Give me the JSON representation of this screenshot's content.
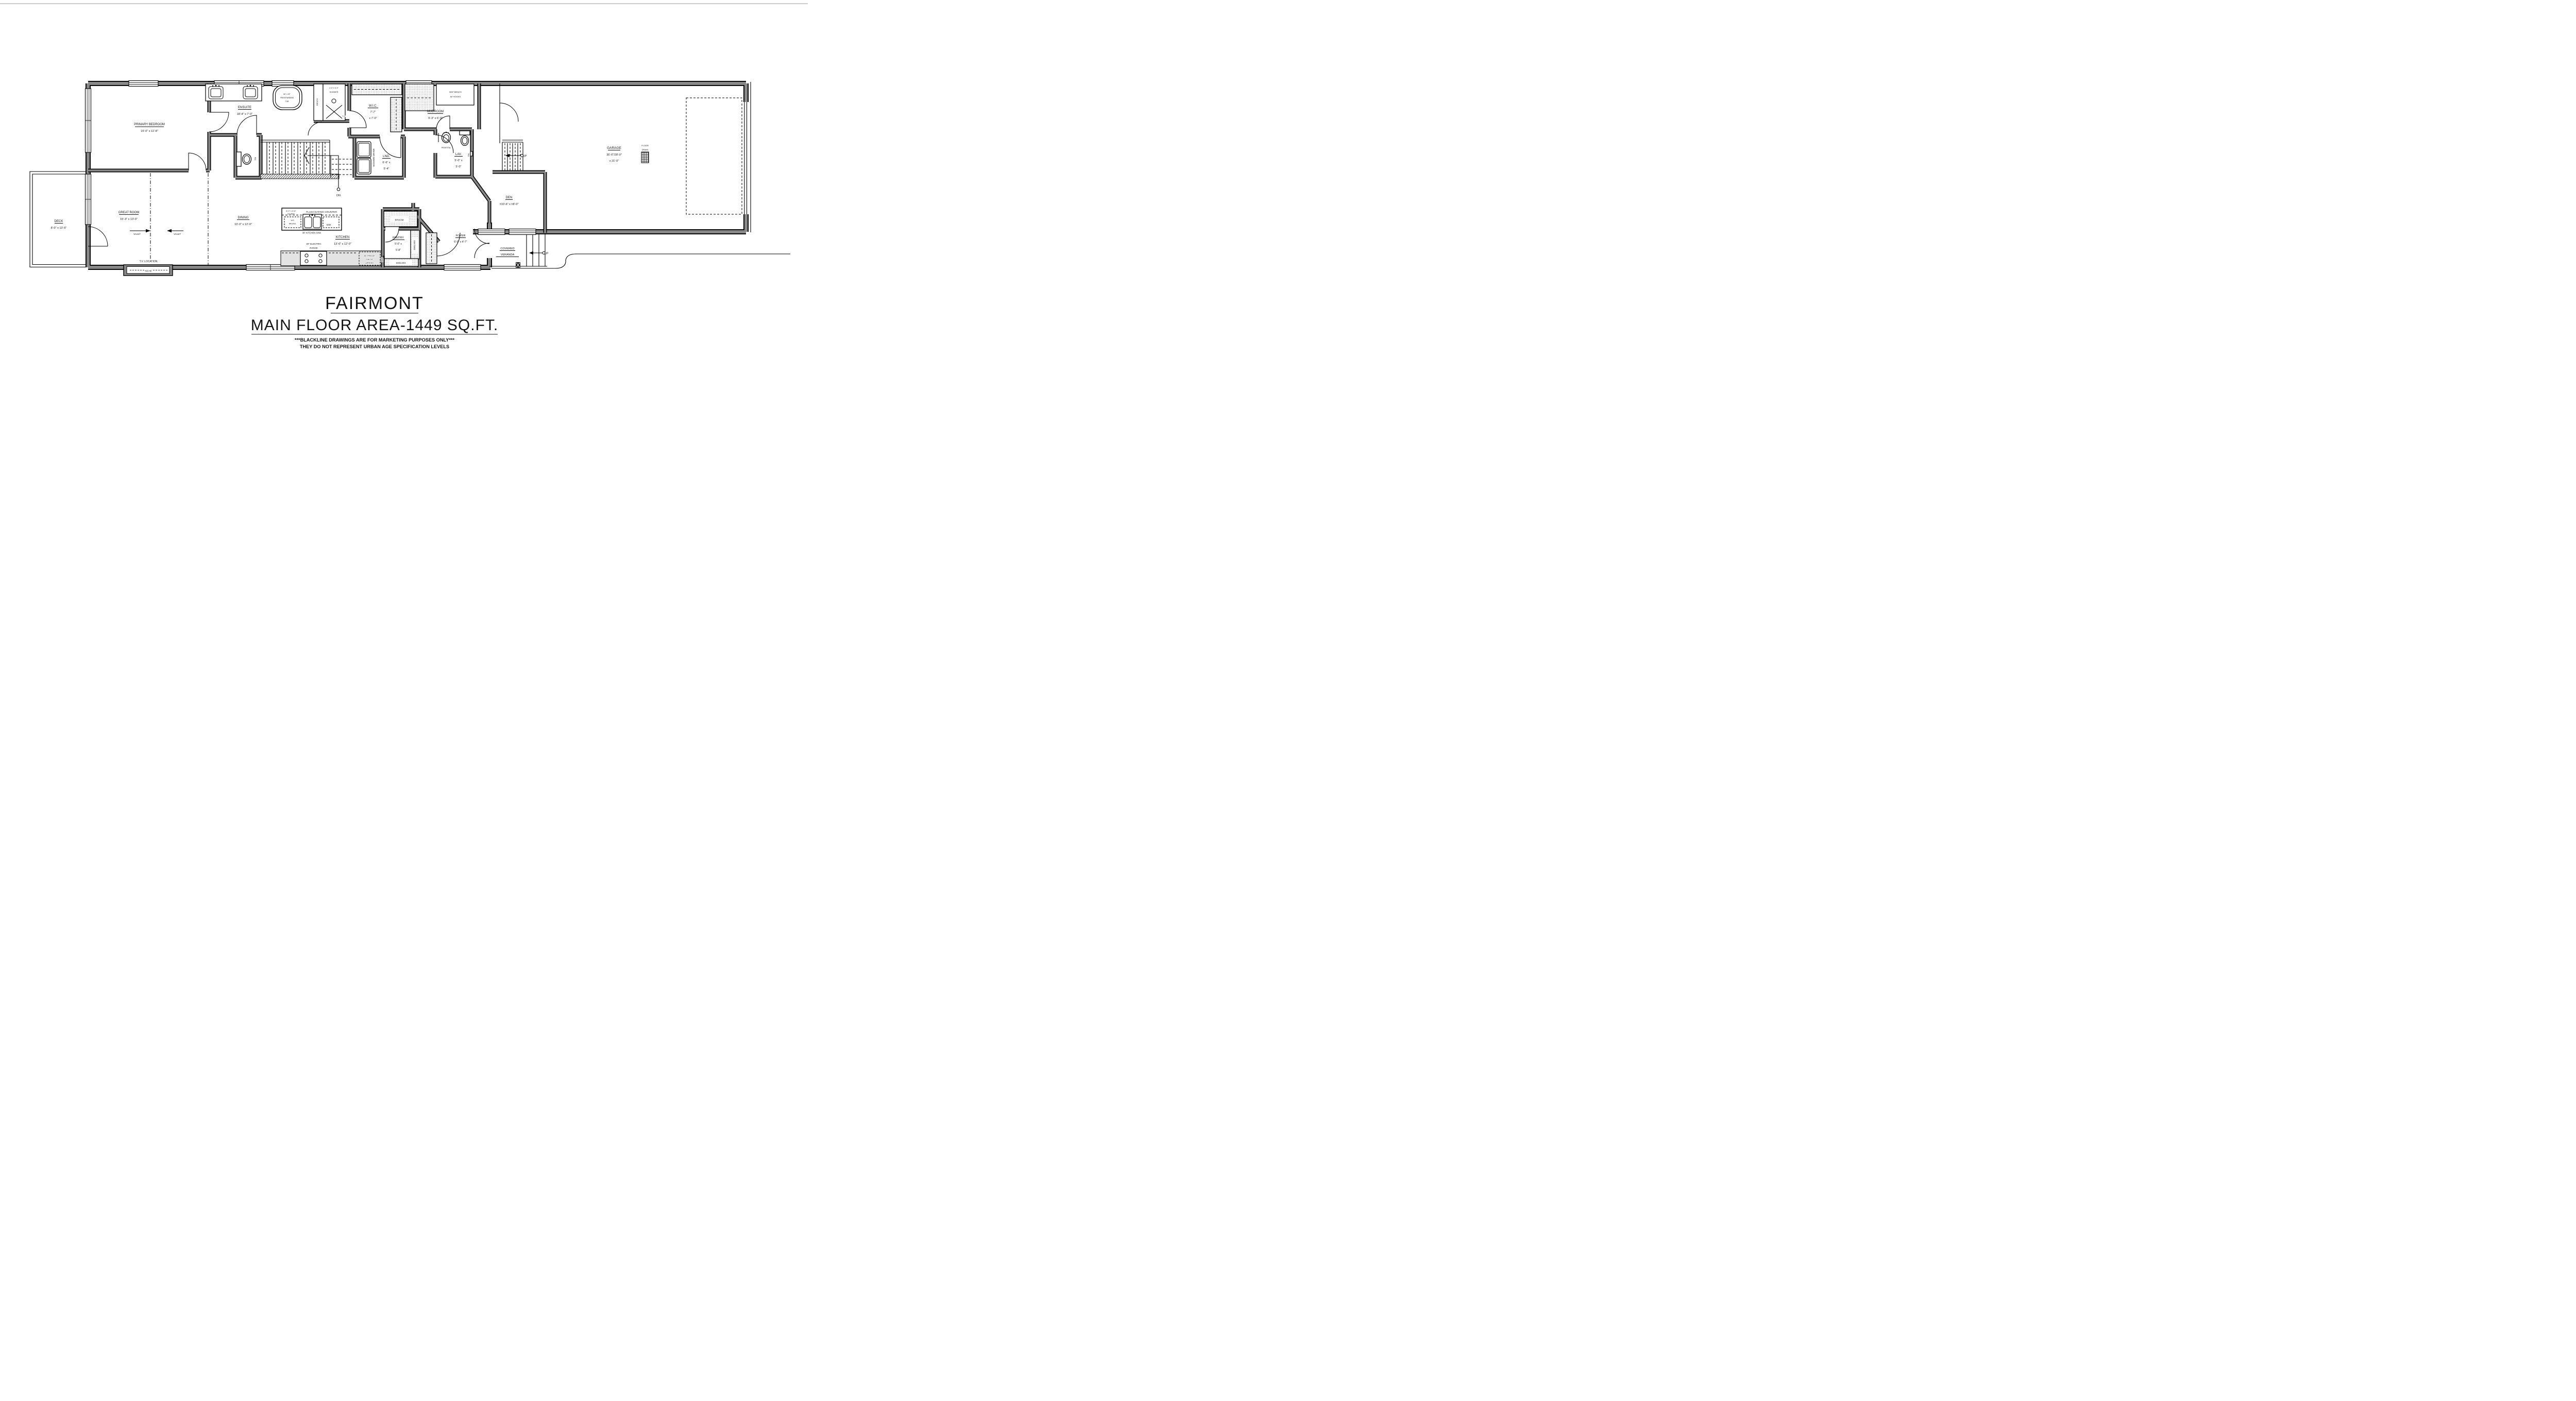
{
  "colors": {
    "wall_fill": "#888888",
    "counter_fill": "#e3e3e3",
    "line": "#000000",
    "paper": "#ffffff"
  },
  "title_block": {
    "plan_name": "FAIRMONT",
    "area_line": "MAIN FLOOR AREA-1449 SQ.FT.",
    "disclaimer1": "***BLACKLINE DRAWINGS ARE FOR MARKETING PURPOSES ONLY***",
    "disclaimer2": "THEY DO NOT REPRESENT URBAN AGE SPECIFICATION LEVELS"
  },
  "rooms": {
    "primary_bedroom": {
      "name": "PRIMARY BEDROOM",
      "dims": "15'-0\" x 11'-8\""
    },
    "ensuite": {
      "name": "ENSUITE",
      "dims": "18'-4\" x 7'-0\""
    },
    "wic": {
      "name": "W.I.C.",
      "dims1": "7'-7\"",
      "dims2": "x 7'-0\""
    },
    "mudroom": {
      "name": "MUDROOM",
      "dims": "9'-3\" x 6'-3\""
    },
    "laundry": {
      "name": "LND.",
      "dims1": "6'-6\" x",
      "dims2": "5'-4\""
    },
    "lav": {
      "name": "LAV.",
      "dims1": "5'-0\" x",
      "dims2": "5'-0\""
    },
    "den": {
      "name": "DEN",
      "dims": "±10'-6\" x ±8'-0\""
    },
    "garage": {
      "name": "GARAGE",
      "dims1": "36'-6\"/28'-0\"",
      "dims2": "x 21'-0\""
    },
    "great_room": {
      "name": "GREAT ROOM",
      "dims": "15'-3\" x 13'-0\""
    },
    "dining": {
      "name": "DINING",
      "dims": "10'-0\" x 12'-0\""
    },
    "kitchen": {
      "name": "KITCHEN",
      "dims": "13'-6\" x 12'-0\""
    },
    "pantry": {
      "name": "PANTRY",
      "dims1": "5'-0\" x",
      "dims2": "5'-8\""
    },
    "foyer": {
      "name": "FOYER",
      "dims": "6'-0\" x 4'-7\""
    },
    "deck": {
      "name": "DECK",
      "dims": "8'-0\" x 13'-6\""
    },
    "veranda": {
      "name1": "COVERED",
      "name2": "VERANDA"
    }
  },
  "fixtures": {
    "tub1": "60\" x 32\"",
    "tub2": "FREESTANDING",
    "tub3": "TUB",
    "shower_size": "4'-0\" X 3'-0\"",
    "shower": "SHOWER",
    "bench": "BENCH",
    "mdf1": "MDF BENCH",
    "mdf2": "W/ HOOKS",
    "washer_dryer": "WASHER/ DRYER",
    "pedestal": "PEDESTAL",
    "tph": "TPH",
    "tc": "T C",
    "floor_drain1": "FLOOR",
    "floor_drain2": "DRAIN",
    "island1": "8'-0\" x 3'-0\"",
    "island2": "ISLAND",
    "flush_counter": "FLUSH EATING COUNTER",
    "uc1": "U/C",
    "uc2": "MICRO.",
    "sink": "30\" KITCHEN SINK",
    "dw": "DW",
    "range1": "30\" ELECTRIC",
    "range2": "RANGE",
    "fridge1": "36\" FRIDGE",
    "fridge2": "C/W 24\"",
    "fridge3": "UPPERS",
    "water": "water",
    "broom": "BROOM",
    "shelves": "SHELVES",
    "tv": "T.V. LOCATION",
    "niche": "NICHE",
    "vault": "VAULT",
    "up": "UP",
    "dn": "DN"
  }
}
